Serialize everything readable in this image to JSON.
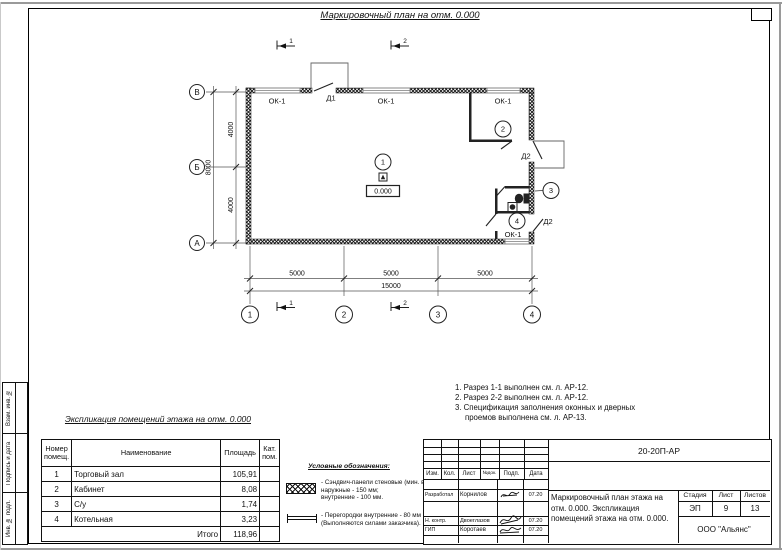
{
  "sheet": {
    "main_title": "Маркировочный план на отм. 0.000",
    "expl_title": "Экспликация помещений этажа на отм. 0.000"
  },
  "plan": {
    "labels": {
      "window": "ОК-1",
      "door1": "Д1",
      "door2": "Д2",
      "elevation": "0.000",
      "room1": "1",
      "room2": "2",
      "room3": "3",
      "room4": "4",
      "axis_v": "В",
      "axis_b": "Б",
      "axis_a": "А",
      "axis_1": "1",
      "axis_2": "2",
      "axis_3": "3",
      "axis_4": "4",
      "section_1": "1",
      "section_2": "2"
    },
    "dims": {
      "bay": "5000",
      "total_h": "15000",
      "half": "4000",
      "total_v": "8000"
    }
  },
  "notes": {
    "line1": "1. Разрез 1-1 выполнен см. л. АР-12.",
    "line2": "2. Разрез 2-2 выполнен см. л. АР-12.",
    "line3": "3. Спецификация заполнения оконных и дверных",
    "line4": "проемов выполнена см. л. АР-13."
  },
  "explication": {
    "headers": {
      "num": "Номер помещ.",
      "name": "Наименование",
      "area": "Площадь",
      "cat": "Кат. пом."
    },
    "rows": [
      {
        "num": "1",
        "name": "Торговый зал",
        "area": "105,91"
      },
      {
        "num": "2",
        "name": "Кабинет",
        "area": "8,08"
      },
      {
        "num": "3",
        "name": "С/у",
        "area": "1,74"
      },
      {
        "num": "4",
        "name": "Котельная",
        "area": "3,23"
      }
    ],
    "total_label": "Итого",
    "total_area": "118,96"
  },
  "legend": {
    "title": "Условные обозначения:",
    "item1": "- Сэндвич-панели стеновые (мин. вата):\nнаружные - 150 мм;\nвнутренние - 100 мм.",
    "item2": "- Перегородки внутренние - 80 мм\n(Выполняются силами заказчика)."
  },
  "titleblock": {
    "doc_number": "20-20П-АР",
    "cols": {
      "izm": "Изм.",
      "kol": "Кол.",
      "list": "Лист",
      "ndoc": "№док.",
      "podp": "Подп.",
      "data": "Дата"
    },
    "row_developer": {
      "role": "Разработал",
      "name": "Корнилов",
      "date": "07.20"
    },
    "row_ncontr": {
      "role": "Н. контр.",
      "name": "Двоеглазов",
      "date": "07.20"
    },
    "row_gip": {
      "role": "ГИП",
      "name": "Коротаев",
      "date": "07.20"
    },
    "stage_label": "Стадия",
    "sheet_label": "Лист",
    "sheets_label": "Листов",
    "stage": "ЭП",
    "sheet_num": "9",
    "sheets_total": "13",
    "description": "Маркировочный план этажа на отм. 0.000. Экспликация помещений этажа на отм. 0.000.",
    "company": "ООО \"Альянс\""
  },
  "side_strip": {
    "c1": "Взам. инв. №",
    "c2": "Подпись и дата",
    "c3": "Инв. № подл."
  }
}
